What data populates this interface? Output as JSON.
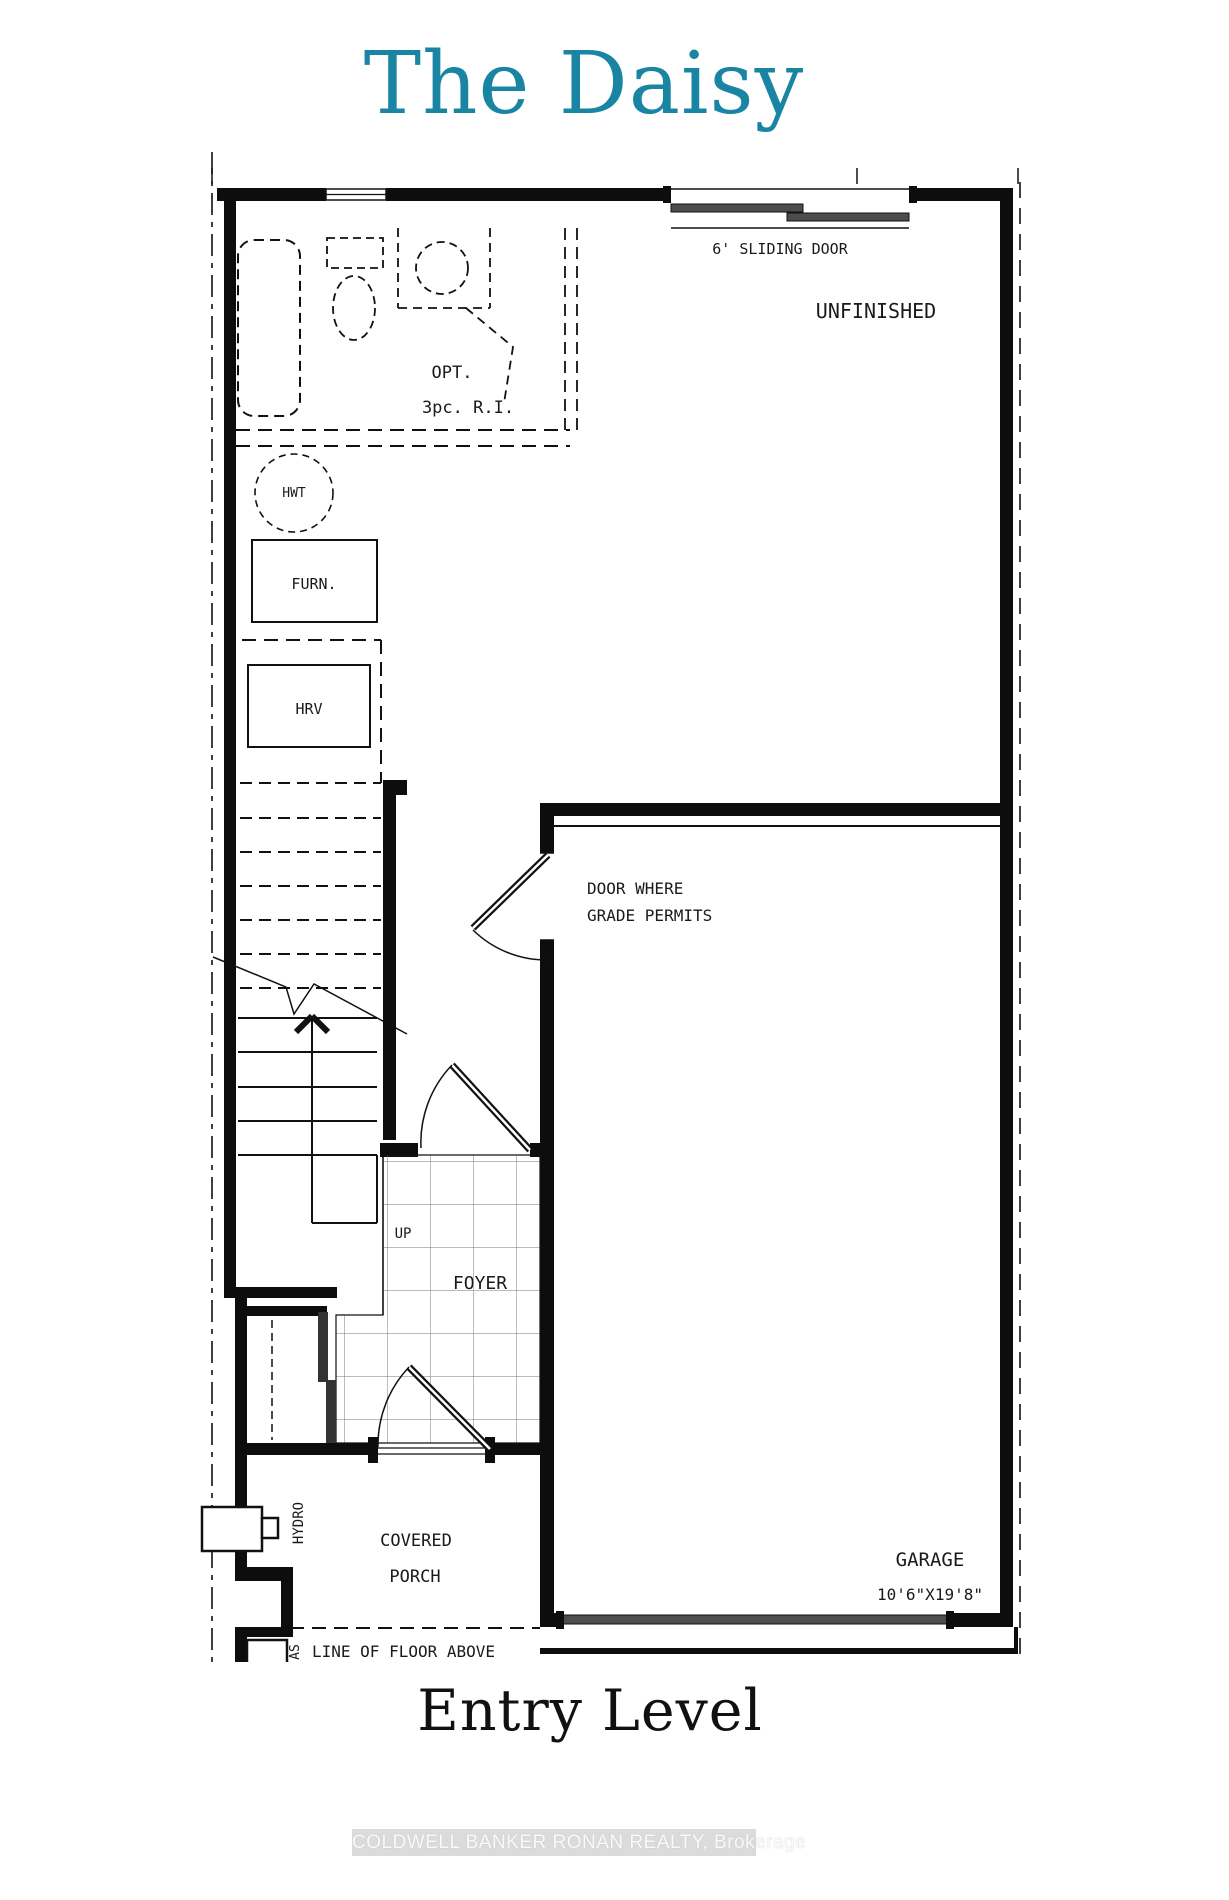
{
  "title": "The Daisy",
  "subtitle": "Entry Level",
  "watermark": "COLDWELL BANKER RONAN REALTY, Brokerage",
  "colors": {
    "accent_teal": "#1985a3",
    "line_black": "#111111",
    "door_gray": "#4d4d4d",
    "watermark_gray": "#bebebe"
  },
  "plan": {
    "labels": {
      "sliding_door": "6' SLIDING DOOR",
      "unfinished": "UNFINISHED",
      "opt_line1": "OPT.",
      "opt_line2": "3pc. R.I.",
      "hwt": "HWT",
      "furnace": "FURN.",
      "hrv": "HRV",
      "grade_door_line1": "DOOR WHERE",
      "grade_door_line2": "GRADE PERMITS",
      "up": "UP",
      "foyer": "FOYER",
      "hydro": "HYDRO",
      "covered": "COVERED",
      "porch": "PORCH",
      "line_of_floor_above": "LINE OF FLOOR ABOVE",
      "gas": "AS",
      "garage": "GARAGE",
      "garage_dim": "10'6\"X19'8\""
    }
  }
}
